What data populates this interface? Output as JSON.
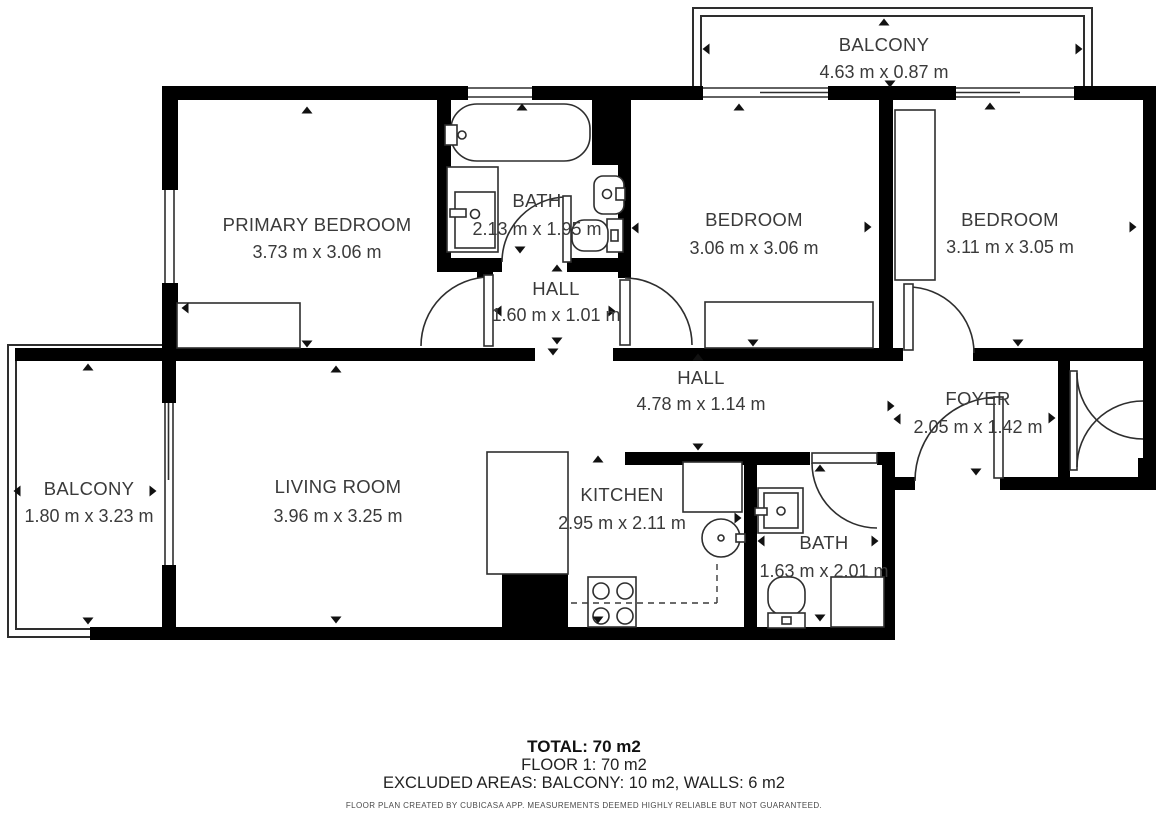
{
  "plan": {
    "rooms": [
      {
        "id": "balcony_top",
        "name": "BALCONY",
        "dims": "4.63 m x 0.87 m"
      },
      {
        "id": "primary_bedroom",
        "name": "PRIMARY BEDROOM",
        "dims": "3.73 m x 3.06 m"
      },
      {
        "id": "bath_1",
        "name": "BATH",
        "dims": "2.13 m x 1.95 m"
      },
      {
        "id": "hall_1",
        "name": "HALL",
        "dims": "1.60 m x 1.01 m"
      },
      {
        "id": "bedroom_mid",
        "name": "BEDROOM",
        "dims": "3.06 m x 3.06 m"
      },
      {
        "id": "bedroom_right",
        "name": "BEDROOM",
        "dims": "3.11 m x 3.05 m"
      },
      {
        "id": "hall_2",
        "name": "HALL",
        "dims": "4.78 m x 1.14 m"
      },
      {
        "id": "foyer",
        "name": "FOYER",
        "dims": "2.05 m x 1.42 m"
      },
      {
        "id": "living_room",
        "name": "LIVING ROOM",
        "dims": "3.96 m x 3.25 m"
      },
      {
        "id": "kitchen",
        "name": "KITCHEN",
        "dims": "2.95 m x 2.11 m"
      },
      {
        "id": "bath_2",
        "name": "BATH",
        "dims": "1.63 m x 2.01 m"
      },
      {
        "id": "balcony_left",
        "name": "BALCONY",
        "dims": "1.80 m x 3.23 m"
      }
    ],
    "footer": {
      "total": "TOTAL: 70 m2",
      "floor": "FLOOR 1: 70 m2",
      "excluded": "EXCLUDED AREAS: BALCONY: 10 m2, WALLS: 6 m2",
      "disclaimer": "FLOOR PLAN CREATED BY CUBICASA APP. MEASUREMENTS DEEMED HIGHLY RELIABLE BUT NOT GUARANTEED."
    },
    "colors": {
      "wall": "#000000",
      "line": "#2e2e2e",
      "text": "#3a3a3a",
      "background": "#ffffff"
    }
  }
}
